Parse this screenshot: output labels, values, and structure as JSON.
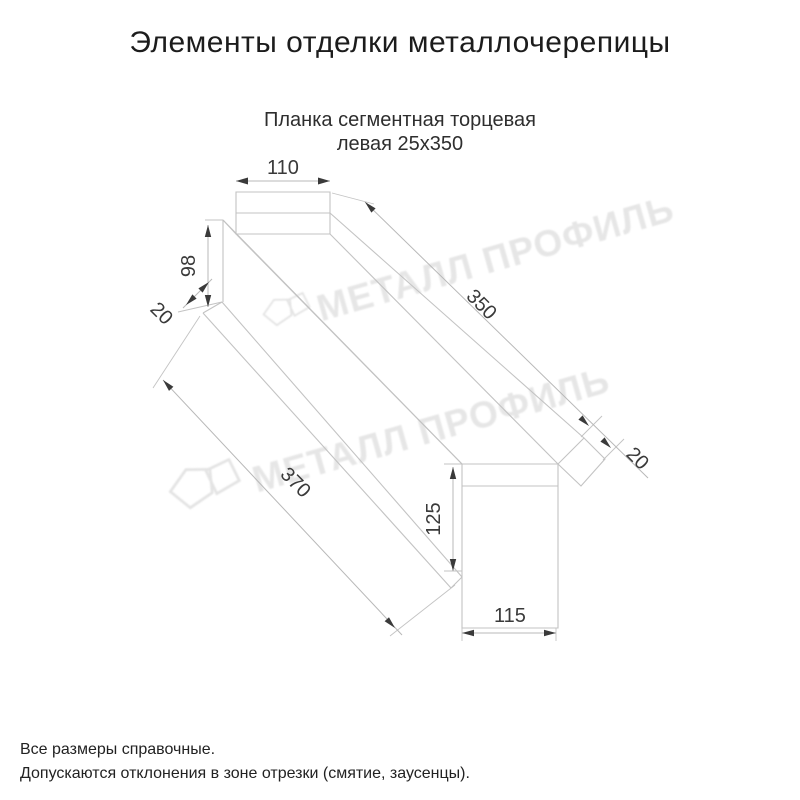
{
  "page": {
    "title": "Элементы отделки металлочерепицы"
  },
  "subtitle": {
    "line1": "Планка сегментная торцевая",
    "line2": "левая 25х350"
  },
  "dimensions": {
    "top_width": "110",
    "near_flange_height": "98",
    "near_hem": "20",
    "top_length": "350",
    "bottom_length": "370",
    "far_flange_height": "125",
    "far_width": "115",
    "far_hem": "20"
  },
  "watermark": {
    "text": "МЕТАЛЛ ПРОФИЛЬ"
  },
  "footer": {
    "line1": "Все размеры справочные.",
    "line2": "Допускаются отклонения в зоне отрезки (смятие, заусенцы)."
  },
  "colors": {
    "drawing_line": "#c3c3c3",
    "dimension_text": "#3a3a3a",
    "watermark": "#d6d6d6",
    "title_text": "#1c1c1c"
  }
}
